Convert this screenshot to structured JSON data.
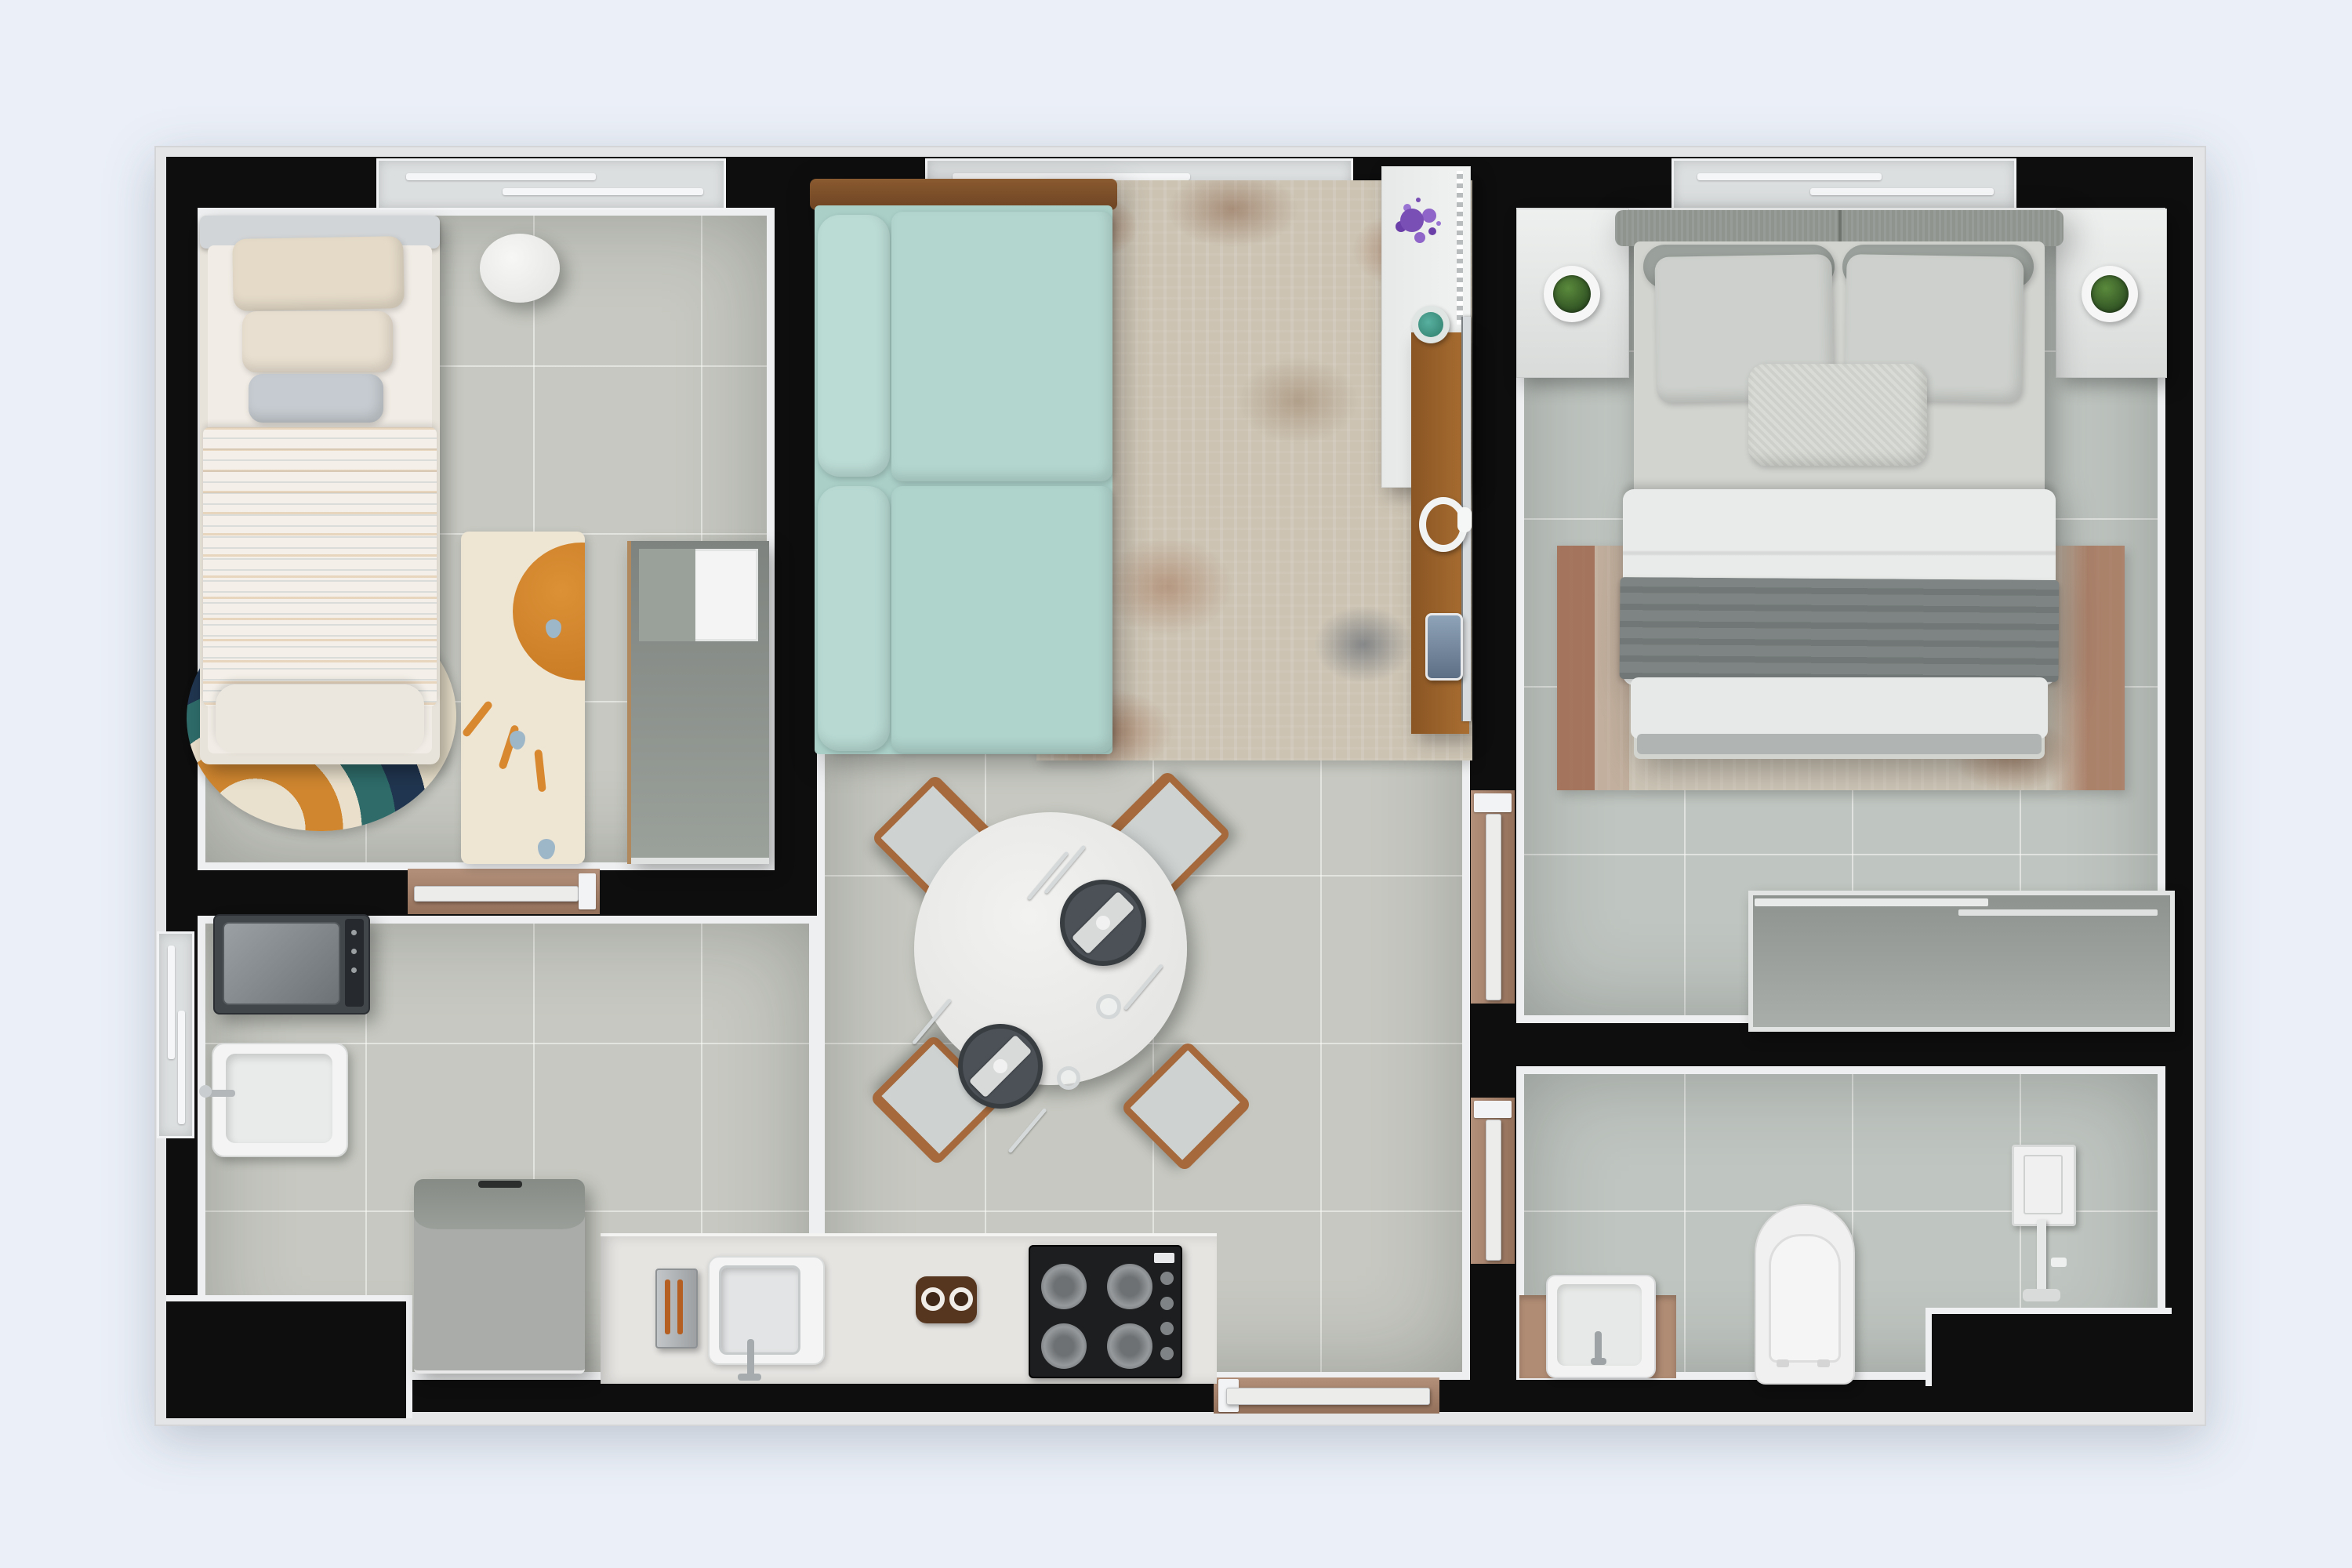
{
  "scene": {
    "title": "Two-bedroom apartment floor plan — top-down 3D render",
    "type": "architectural-floorplan-render",
    "background_color": "#ebf0f8",
    "wall_color": "#0e0e0f",
    "outer_trim_color": "#e4e5e7",
    "floor_tile_color": "#c6c8c1",
    "threshold_wood_color": "#a8846b",
    "accent_sofa_color": "#a9cfc7",
    "accent_rug_rust_color": "#9a5c3c"
  },
  "rooms": [
    {
      "label": "Kids bedroom",
      "position": "top-left"
    },
    {
      "label": "Living and dining room with open kitchen",
      "position": "center"
    },
    {
      "label": "Laundry / service area",
      "position": "bottom-left"
    },
    {
      "label": "Master bedroom",
      "position": "top-right"
    },
    {
      "label": "Bathroom",
      "position": "bottom-right"
    }
  ],
  "furniture": {
    "kids_bed": {
      "label": "Single bed with striped duvet"
    },
    "kids_side_table": {
      "label": "Round side table"
    },
    "sun_rug": {
      "label": "Sun motif kids rug"
    },
    "rainbow_rug": {
      "label": "Rainbow oval rug with plush toys"
    },
    "plush_toys": {
      "label": "Plush toys"
    },
    "kids_wardrobe": {
      "label": "Open wardrobe shelf unit"
    },
    "sofa": {
      "label": "Teal fabric sofa with wood frame"
    },
    "living_rug": {
      "label": "Distressed beige-rust area rug"
    },
    "sideboard": {
      "label": "White sideboard"
    },
    "media_desk": {
      "label": "Wood media console"
    },
    "tv": {
      "label": "Flat-screen TV"
    },
    "purple_plant": {
      "label": "Purple houseplant"
    },
    "cactus": {
      "label": "Potted succulent"
    },
    "headphones": {
      "label": "White headphones"
    },
    "phone": {
      "label": "Smartphone"
    },
    "dining_table": {
      "label": "Round dining table set for two"
    },
    "dining_chair": {
      "label": "Wood dining chair with gray cushion"
    },
    "place_setting": {
      "label": "Dark plate with napkin"
    },
    "kitchen_counter": {
      "label": "Kitchen counter"
    },
    "cooktop": {
      "label": "Black 4-burner gas cooktop"
    },
    "kitchen_sink": {
      "label": "Square kitchen sink with faucet"
    },
    "toaster": {
      "label": "Stainless toaster"
    },
    "trivet": {
      "label": "Wood trivet with bowls"
    },
    "fridge": {
      "label": "Refrigerator"
    },
    "washer": {
      "label": "Washing machine"
    },
    "laundry_tub": {
      "label": "Utility wash tub"
    },
    "master_bed": {
      "label": "Double bed with gray throw blanket"
    },
    "nightstand_left": {
      "label": "Nightstand with potted plant"
    },
    "nightstand_right": {
      "label": "Nightstand with potted plant"
    },
    "master_rug": {
      "label": "Distressed rust-edged rug"
    },
    "dresser": {
      "label": "Low gray wardrobe dresser"
    },
    "vanity": {
      "label": "Vanity sink on wood counter"
    },
    "toilet": {
      "label": "Toilet"
    },
    "shower": {
      "label": "Shower column"
    }
  },
  "openings": {
    "windows": [
      {
        "label": "Kids bedroom window",
        "wall": "top"
      },
      {
        "label": "Living room window",
        "wall": "top"
      },
      {
        "label": "Master bedroom window",
        "wall": "top"
      },
      {
        "label": "Laundry window",
        "wall": "left"
      }
    ],
    "doors": [
      {
        "label": "Kids bedroom door"
      },
      {
        "label": "Apartment entrance door"
      },
      {
        "label": "Master bedroom door"
      },
      {
        "label": "Bathroom door"
      }
    ]
  }
}
